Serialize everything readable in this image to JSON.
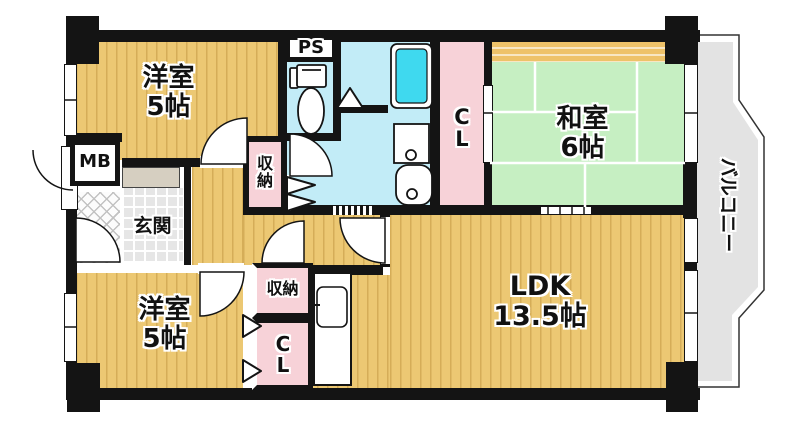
{
  "floorplan": {
    "type": "apartment-floor-plan",
    "rooms": {
      "western_top": {
        "name": "洋室",
        "size": "5帖"
      },
      "western_bottom": {
        "name": "洋室",
        "size": "5帖"
      },
      "japanese": {
        "name": "和室",
        "size": "6帖"
      },
      "ldk": {
        "name": "LDK",
        "size": "13.5帖"
      },
      "entrance": {
        "name": "玄関"
      },
      "balcony": {
        "name": "バルコニー"
      }
    },
    "fixtures": {
      "pipe_space": "PS",
      "meter_box": "MB",
      "closet_top": "CL",
      "closet_bottom": "CL",
      "storage_top": "収納",
      "storage_bottom": "収納"
    },
    "icons": {
      "toilet": "toilet-icon",
      "bathtub": "bathtub-icon",
      "washing_machine_pan": "washing-machine-pan-icon",
      "washbasin": "washbasin-icon",
      "kitchen_sink": "kitchen-sink-icon"
    },
    "colors": {
      "wall": "#141414",
      "room_floor": "#ecc873",
      "tatami": "#c6efc2",
      "wet_area": "#c2ecf7",
      "bathtub": "#3fd9ef",
      "closet": "#f7d2d8",
      "oshiire_band": "#eec269",
      "balcony": "#e3e3e3",
      "entrance_tile": "#e6e6e6"
    }
  }
}
